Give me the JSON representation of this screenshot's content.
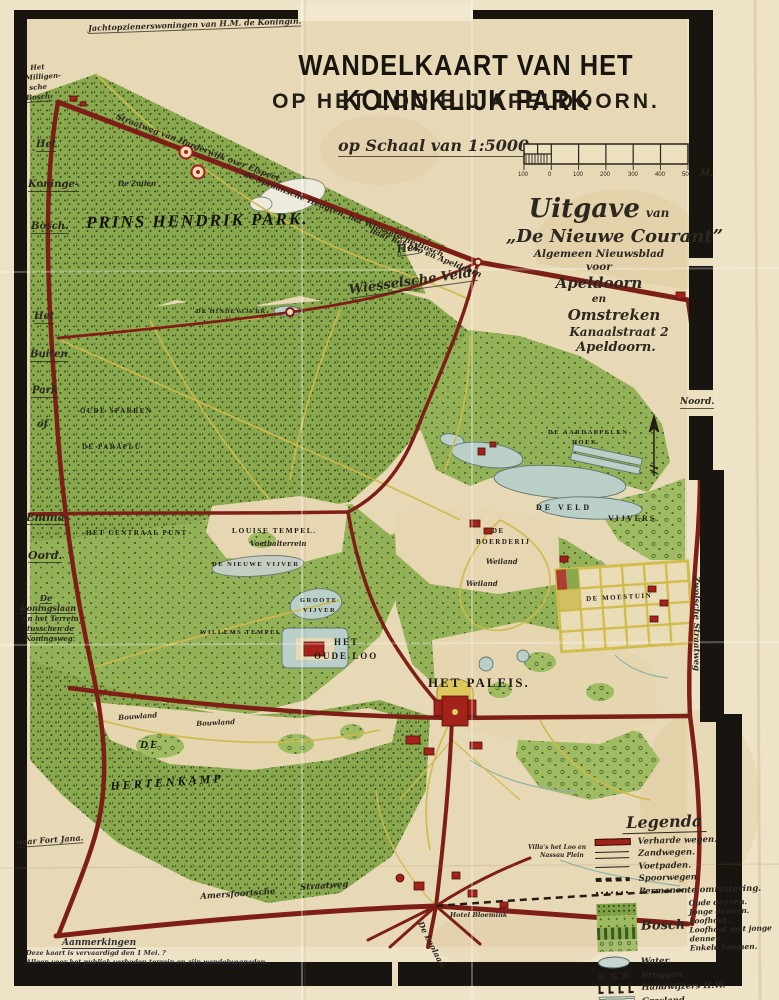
{
  "header": {
    "title_line1": "WANDELKAART VAN HET KONINKLIJK PARK",
    "title_line2": "OP HET LOO BIJ APELDOORN.",
    "scale_label": "op Schaal van 1:5000 _",
    "scale_ticks": [
      "100",
      "0",
      "100",
      "200",
      "300",
      "400",
      "500"
    ],
    "scale_unit": "M."
  },
  "publisher": {
    "word1": "Uitgave",
    "word2": "van",
    "name": "„De Nieuwe Courant”",
    "sub1": "Algemeen Nieuwsblad",
    "sub2": "voor",
    "sub3": "Apeldoorn",
    "sub4": "en",
    "sub5": "Omstreken",
    "sub6": "Kanaalstraat 2",
    "sub7": "Apeldoorn."
  },
  "map_labels": {
    "corner_note": "Jachtopzienerswoningen van H.M. de Koningin.",
    "road_top_a": "Straatweg van Harderwijk over Elspeet,",
    "road_top_b": "de Spraansche Heugten, het Wiesselsche Bosch",
    "road_top_c": "naar het Loo en Apeldoorn",
    "milligensche_1": "Het",
    "milligensche_2": "Milligen-",
    "milligensche_3": "sche",
    "milligensche_4": "Bosch.",
    "koningsbosch_1": "Het",
    "koningsbosch_2": "Koninge-",
    "koningsbosch_3": "Bosch.",
    "buitenpark_1": "Het",
    "buitenpark_2": "Buiten",
    "buitenpark_3": "Park",
    "buitenpark_4": "of",
    "emma_1": "Emma-",
    "emma_2": "Oord.",
    "koningslaan_1": "De",
    "koningslaan_2": "Koningslaan",
    "koningslaan_3": "en het Terrein",
    "koningslaan_4": "tusschen de",
    "koningslaan_5": "Koningsweg.",
    "naar_fort": "naar Fort Jana.",
    "de_zuilen": "De Zuilen",
    "prins_hendrik_park": "PRINS HENDRIK PARK.",
    "wiessel_het": "Het",
    "wiessel_veld": "Wiesselsche Veld.",
    "hindevijver": "DE HINDEVIJVER",
    "oude_sparren": "OUDE SPARREN",
    "de_paraplu": "DE PARAPLU",
    "centraal": "HET CENTRAAL PUNT",
    "louise_tempel": "LOUISE TEMPEL.",
    "voetbalterrein": "Voetbalterrein",
    "nieuwe_vijver": "DE NIEUWE VIJVER",
    "willems_tempel": "WILLEMS TEMPEL",
    "boerderij_1": "DE",
    "boerderij_2": "BOERDERIJ",
    "weiland_a": "Weiland",
    "weiland_b": "Weiland",
    "aardappelen_1": "DE AARDAPPELEN",
    "aardappelen_2": "HOEK",
    "veldvijvers_1": "DE VELD",
    "veldvijvers_2": "VIJVERS.",
    "groote_vijver_1": "GROOTE",
    "groote_vijver_2": "VIJVER",
    "oudeloo_1": "HET",
    "oudeloo_2": "OUDE LOO",
    "het_paleis": "HET PALEIS.",
    "moestuin": "DE MOESTUIN",
    "hertenkamp_1": "DE",
    "hertenkamp_2": "HERTENKAMP",
    "bouwland_a": "Bouwland",
    "bouwland_b": "Bouwland",
    "amersfoortsche": "Amersfoortsche",
    "straatweg": "Straatweg",
    "loolaan": "De Loolaan",
    "hotel_bloemink": "Hotel Bloemink",
    "villas_1": "Villa's het Loo en",
    "villas_2": "Nassau Plein",
    "zwolsche": "Zwolsche Straatweg",
    "noord": "Noord."
  },
  "legend": {
    "title": "Legenda",
    "verharde": "Verharde wegen.",
    "zandwegen": "Zandwegen.",
    "voetpaden": "Voetpaden.",
    "spoorwegen": "Spoorwegen.",
    "omrastering": "Permanente omrastering.",
    "bosch": "Bosch",
    "bosch_sub": [
      "Oude dennen.",
      "Jonge dennen.",
      "Loofhout.",
      "Loofhout met jonge dennen.",
      "Enkele boomen."
    ],
    "water": "Water.",
    "bruggen": "Bruggen.",
    "handwijzers": "Handwijzers H.W.",
    "grasland": "Grasland.",
    "gebouwen": "Gebouwen.",
    "credit_1": "Apeldoorn 2 Mei.",
    "credit_2": "Hamers-Salman,",
    "credit_3": "Litograaf en teekenaar."
  },
  "remarks": {
    "title": "Aanmerkingen",
    "line1": "Deze kaart is vervaardigd den 1 Mei.  ?",
    "line2": "Alleen voor het publiek verboden terrein en zijn wandelwegpaden."
  },
  "colors": {
    "road": "#7e1f17",
    "forest": "#8aa94e",
    "water": "#b9cfc8",
    "building": "#a3231b",
    "paper": "#e7d9b6",
    "ink": "#231d15"
  }
}
